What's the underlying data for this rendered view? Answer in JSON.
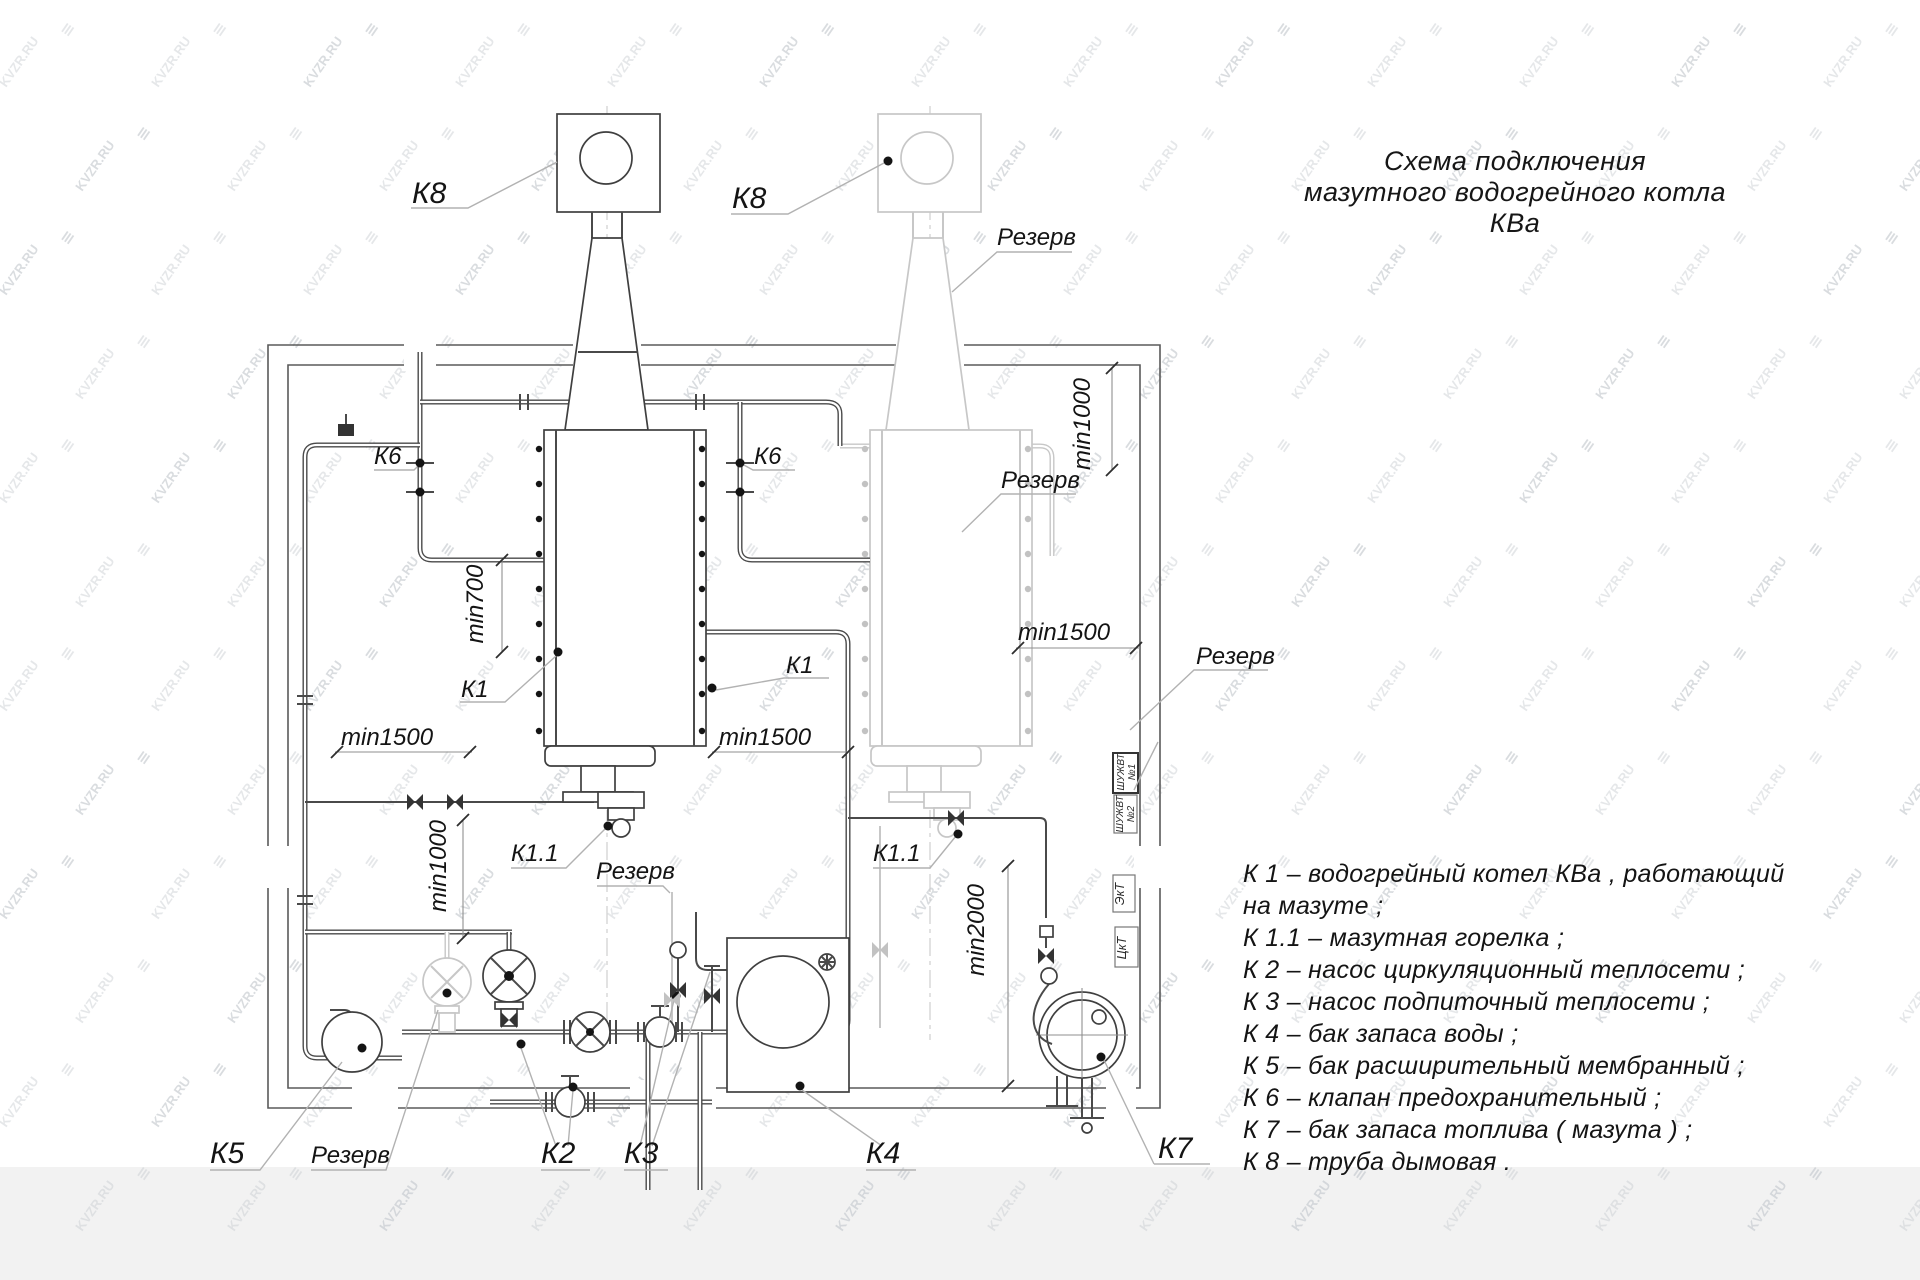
{
  "page": {
    "background": "#ffffff",
    "bottom_band_color": "#f2f2f2"
  },
  "watermark": {
    "text": "KVZR.RU",
    "icon_char": "≡",
    "color": "#c3c8cd"
  },
  "title": {
    "line1": "Схема подключения",
    "line2": "мазутного водогрейного котла КВа"
  },
  "legend": {
    "lines": [
      "К 1 –  водогрейный котел КВа , работающий",
      "на мазуте ;",
      "К 1.1 –  мазутная горелка ;",
      "К 2 –  насос циркуляционный теплосети ;",
      "К 3 –  насос подпиточный теплосети ;",
      "К 4 –  бак запаса воды ;",
      "К 5 –  бак расширительный мембранный ;",
      "К 6 –  клапан предохранительный ;",
      "К 7 –  бак запаса топлива  ( мазута ) ;",
      "К 8 –  труба дымовая ."
    ]
  },
  "diagram": {
    "colors": {
      "line": "#4a4a4a",
      "reserve": "#c7c7c7",
      "label": "#141414"
    },
    "labels": [
      {
        "id": "k8-left",
        "text": "К8",
        "x": 412,
        "y": 203,
        "size": "lg"
      },
      {
        "id": "k8-right",
        "text": "К8",
        "x": 732,
        "y": 208,
        "size": "lg"
      },
      {
        "id": "rezerv-chimney",
        "text": "Резерв",
        "x": 997,
        "y": 245,
        "size": "md"
      },
      {
        "id": "k6-left",
        "text": "К6",
        "x": 374,
        "y": 464,
        "size": "md"
      },
      {
        "id": "k6-right",
        "text": "К6",
        "x": 754,
        "y": 464,
        "size": "md"
      },
      {
        "id": "min1000-top",
        "text": "min1000",
        "x": 1090,
        "y": 424,
        "rot": -90,
        "size": "md"
      },
      {
        "id": "min700",
        "text": "min700",
        "x": 483,
        "y": 604,
        "rot": -90,
        "size": "md"
      },
      {
        "id": "k1-left",
        "text": "К1",
        "x": 461,
        "y": 697,
        "size": "md"
      },
      {
        "id": "k1-right",
        "text": "К1",
        "x": 786,
        "y": 673,
        "size": "md"
      },
      {
        "id": "min1500-left",
        "text": "min1500",
        "x": 341,
        "y": 745,
        "size": "md"
      },
      {
        "id": "min1500-mid",
        "text": "min1500",
        "x": 719,
        "y": 745,
        "size": "md"
      },
      {
        "id": "rezerv-boiler",
        "text": "Резерв",
        "x": 1001,
        "y": 488,
        "size": "md"
      },
      {
        "id": "min1500-right",
        "text": "min1500",
        "x": 1018,
        "y": 640,
        "size": "md"
      },
      {
        "id": "rezerv-right",
        "text": "Резерв",
        "x": 1196,
        "y": 664,
        "size": "md"
      },
      {
        "id": "k1-1-left",
        "text": "К1.1",
        "x": 511,
        "y": 861,
        "size": "md"
      },
      {
        "id": "rezerv-burner",
        "text": "Резерв",
        "x": 596,
        "y": 879,
        "size": "md"
      },
      {
        "id": "k1-1-right",
        "text": "К1.1",
        "x": 873,
        "y": 861,
        "size": "md"
      },
      {
        "id": "min1000-bottom",
        "text": "min1000",
        "x": 446,
        "y": 866,
        "rot": -90,
        "size": "md"
      },
      {
        "id": "min2000",
        "text": "min2000",
        "x": 984,
        "y": 930,
        "rot": -90,
        "size": "md"
      },
      {
        "id": "k5",
        "text": "К5",
        "x": 210,
        "y": 1163,
        "size": "lg"
      },
      {
        "id": "rezerv-bottom",
        "text": "Резерв",
        "x": 311,
        "y": 1163,
        "size": "md"
      },
      {
        "id": "k2",
        "text": "К2",
        "x": 541,
        "y": 1163,
        "size": "lg"
      },
      {
        "id": "k3",
        "text": "К3",
        "x": 624,
        "y": 1163,
        "size": "lg"
      },
      {
        "id": "k4",
        "text": "К4",
        "x": 866,
        "y": 1163,
        "size": "lg"
      },
      {
        "id": "k7",
        "text": "К7",
        "x": 1158,
        "y": 1158,
        "size": "lg"
      },
      {
        "id": "cabinet-1",
        "lines": [
          "ШУЖВТ",
          "№1"
        ],
        "x": 1126,
        "y": 772,
        "rot": -90,
        "size": "xs"
      },
      {
        "id": "cabinet-2",
        "lines": [
          "ШУЖВТ",
          "№2"
        ],
        "x": 1125,
        "y": 814,
        "rot": -90,
        "size": "xs"
      },
      {
        "id": "cabinet-3",
        "text": "ЭкТ",
        "x": 1124,
        "y": 894,
        "rot": -90,
        "size": "sm"
      },
      {
        "id": "cabinet-4",
        "text": "ЦкТ",
        "x": 1126,
        "y": 948,
        "rot": -90,
        "size": "sm"
      }
    ]
  }
}
